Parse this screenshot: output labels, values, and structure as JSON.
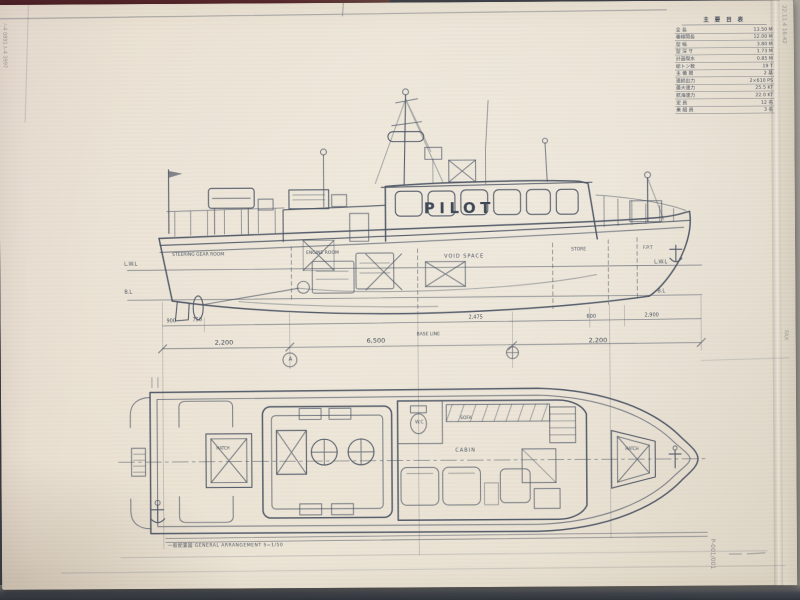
{
  "fax": {
    "left_edge_vertical": "ﾉ-4 0891 ﾙ-4 3997",
    "top_right_stamp": "22.11.4  16:42",
    "right_edge_fax": "FAX",
    "page_number": "P-001/001"
  },
  "spec_table": {
    "title": "主 要 目 表",
    "rows": [
      {
        "label": "全  長",
        "value": "13.50 M"
      },
      {
        "label": "垂線間長",
        "value": "12.00 M"
      },
      {
        "label": "型  幅",
        "value": "3.80 M"
      },
      {
        "label": "型 深 サ",
        "value": "1.73 M"
      },
      {
        "label": "計画喫水",
        "value": "0.85 M"
      },
      {
        "label": "総トン数",
        "value": "19 T"
      },
      {
        "label": "主 機 関",
        "value": "2 基"
      },
      {
        "label": "連続出力",
        "value": "2×610 PS"
      },
      {
        "label": "最大速力",
        "value": "25.5 KT"
      },
      {
        "label": "航海速力",
        "value": "22.0 KT"
      },
      {
        "label": "定  員",
        "value": "12 名"
      },
      {
        "label": "乗 組 員",
        "value": "3 名"
      }
    ]
  },
  "side_view": {
    "boat_name": "PILOT",
    "compartments": {
      "aft": "STEERING GEAR ROOM",
      "engine": "ENGINE ROOM",
      "mid": "VOID SPACE",
      "store": "STORE",
      "fore": "F.P.T"
    },
    "waterlines": {
      "lwl_left": "L.W.L",
      "bl_left": "B.L",
      "lwl_right": "L.W.L",
      "bl_right": "B.L",
      "base_line": "BASE LINE"
    },
    "dims_upper": [
      "900",
      "750",
      "2,475",
      "600",
      "2,900"
    ],
    "dims_lower": [
      "2,200",
      "6,500",
      "2,200"
    ],
    "section_marker": "A"
  },
  "plan_view": {
    "labels": {
      "wc": "W.C",
      "sofa": "SOFA",
      "cabin": "CABIN",
      "aft_hatch": "HATCH",
      "bow_hatch": "HATCH"
    },
    "note": "一般配置図  GENERAL ARRANGEMENT  S=1/50"
  }
}
